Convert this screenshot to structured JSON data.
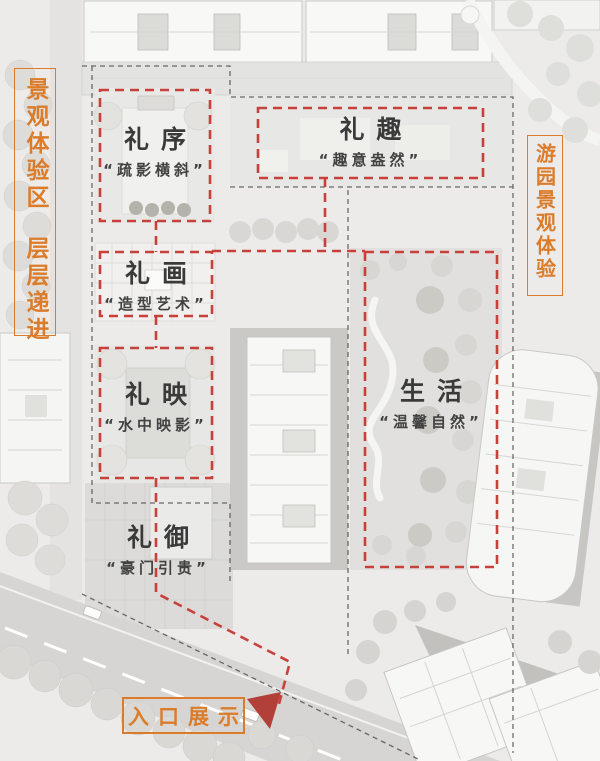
{
  "figure": {
    "type": "landscape-masterplan-annotation",
    "palette": {
      "accent_orange": "#db7c2b",
      "annotation_red": "#c8403a",
      "arrow_red": "#b23f38",
      "title_color": "#3a3a3a",
      "plan_base": "#ecebe9"
    }
  },
  "side_labels": {
    "left_line1": "景观体验区",
    "left_line2": "层层递进",
    "right_line": "游园景观体验"
  },
  "zones": [
    {
      "id": "lixu",
      "title": "礼序",
      "subtitle": "“疏影横斜”"
    },
    {
      "id": "liqu",
      "title": "礼趣",
      "subtitle": "“趣意盎然”"
    },
    {
      "id": "lihua",
      "title": "礼画",
      "subtitle": "“造型艺术”"
    },
    {
      "id": "liying",
      "title": "礼映",
      "subtitle": "“水中映影”"
    },
    {
      "id": "shenghuo",
      "title": "生活",
      "subtitle": "“温馨自然”"
    },
    {
      "id": "liyu",
      "title": "礼御",
      "subtitle": "“豪门引贵”"
    }
  ],
  "entrance_label": {
    "text": "入口展示"
  }
}
